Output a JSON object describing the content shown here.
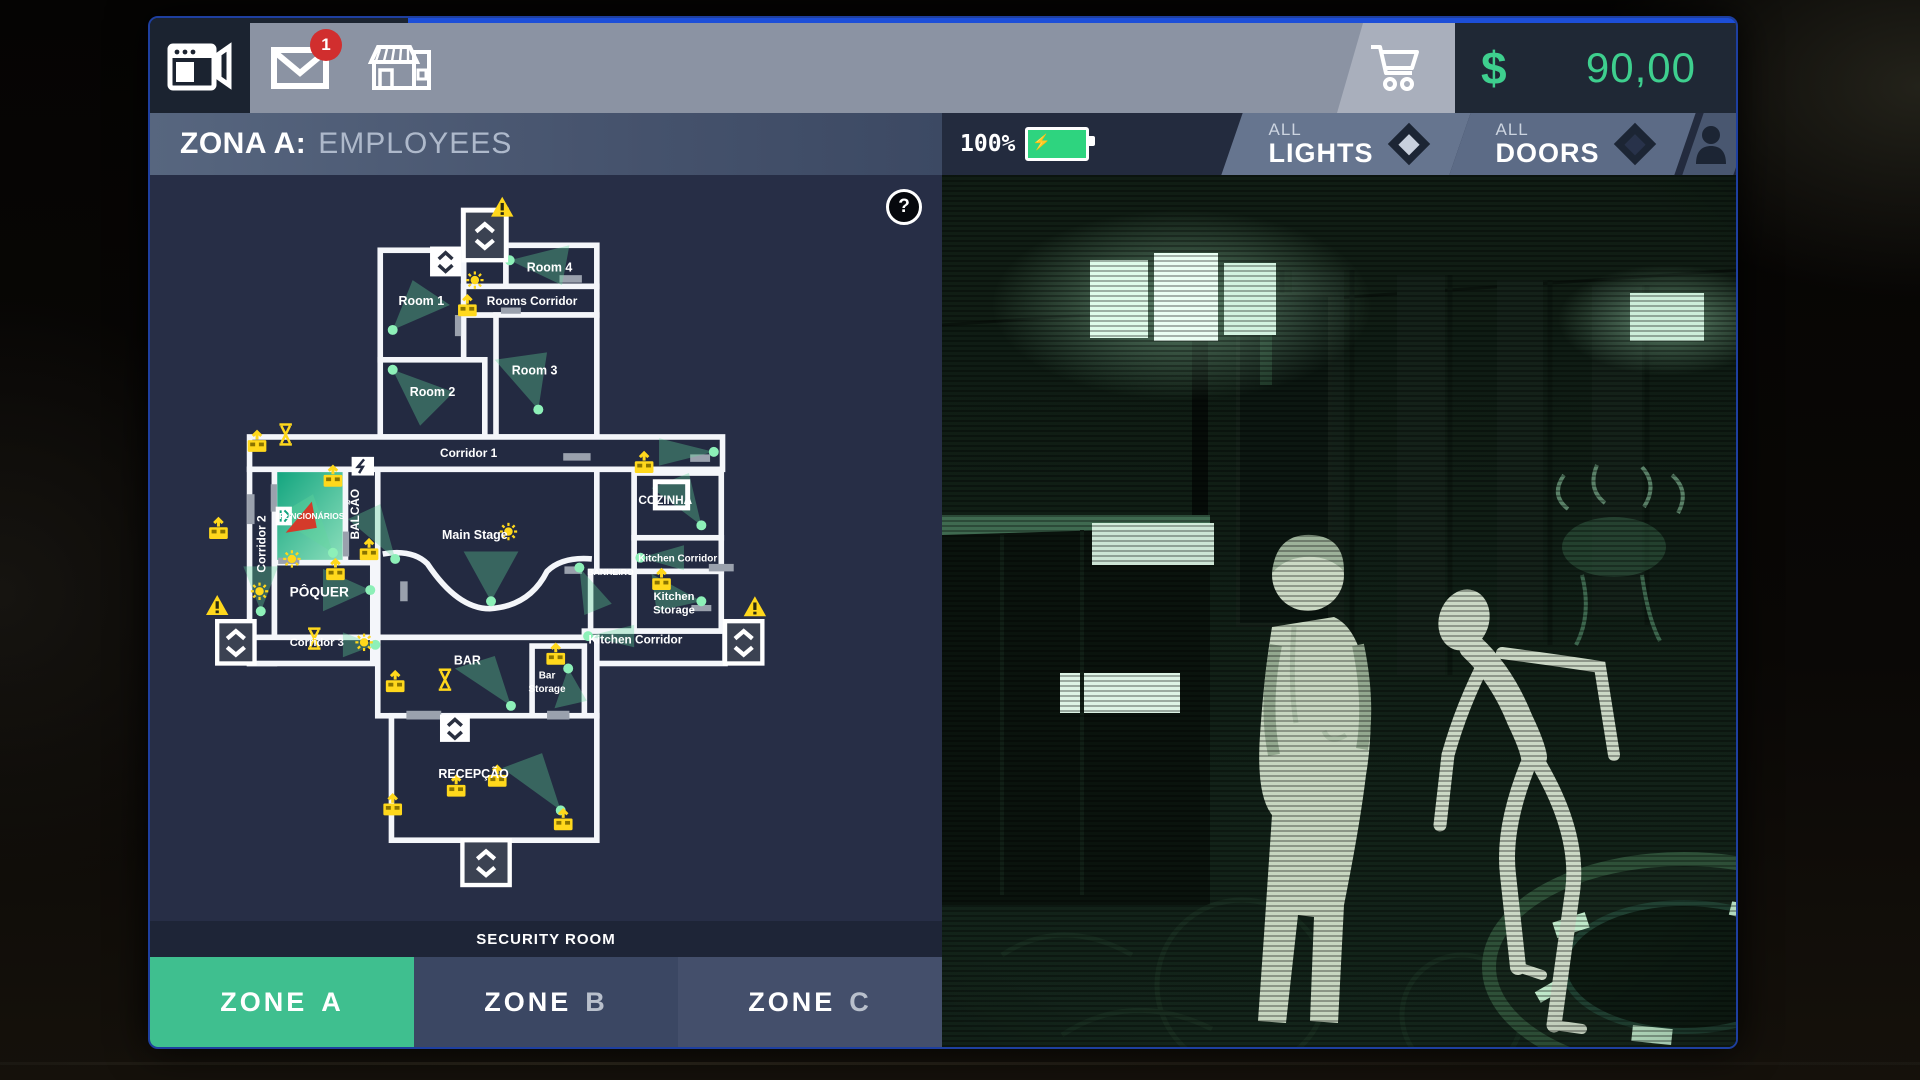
{
  "topbar": {
    "cameras_tab": {
      "icon": "camera-monitor-icon"
    },
    "mail_tab": {
      "icon": "mail-icon",
      "badge": "1"
    },
    "shop_tab": {
      "icon": "storefront-icon"
    },
    "cart": {
      "icon": "cart-icon"
    },
    "wallet": {
      "symbol": "$",
      "amount": "90,00"
    }
  },
  "header": {
    "zone_prefix": "ZONA A:",
    "zone_title": "EMPLOYEES",
    "battery": {
      "percent": "100%"
    },
    "lights_toggle": {
      "top": "ALL",
      "bottom": "LIGHTS",
      "state": "on"
    },
    "doors_toggle": {
      "top": "ALL",
      "bottom": "DOORS",
      "state": "off"
    }
  },
  "map": {
    "help": "?",
    "security_room": "SECURITY ROOM",
    "rooms": {
      "room1": "Room 1",
      "room2": "Room 2",
      "room3": "Room 3",
      "room4": "Room 4",
      "rooms_corridor": "Rooms Corridor",
      "corridor1": "Corridor 1",
      "corridor2": "Corridor 2",
      "corridor3": "Corridor 3",
      "funcionarios": "FUNCIONÁRIOS",
      "balcao": "BALCÃO",
      "poquer": "PÔQUER",
      "main_stage": "Main Stage",
      "cozinha": "COZINHA",
      "banheiro": "BANHEIRO",
      "kitchen_corridor_upper": "Kitchen Corridor",
      "kitchen_corridor_lower": "Kitchen Corridor",
      "kitchen_storage_line1": "Kitchen",
      "kitchen_storage_line2": "Storage",
      "bar": "BAR",
      "bar_storage_line1": "Bar",
      "bar_storage_line2": "Storage",
      "recepcao": "RECEPÇÃO"
    }
  },
  "zones": {
    "a": {
      "word": "ZONE",
      "letter": "A",
      "active": true
    },
    "b": {
      "word": "ZONE",
      "letter": "B",
      "active": false
    },
    "c": {
      "word": "ZONE",
      "letter": "C",
      "active": false
    }
  },
  "colors": {
    "accent_green": "#3fbf8f",
    "money_green": "#3ecf8e",
    "alert_yellow": "#ffd81c",
    "badge_red": "#d12e2e",
    "night_vision_green": "#9fd8b0",
    "topbar_gray": "#8b93a3",
    "blue_strip": "#1c4ed8"
  }
}
